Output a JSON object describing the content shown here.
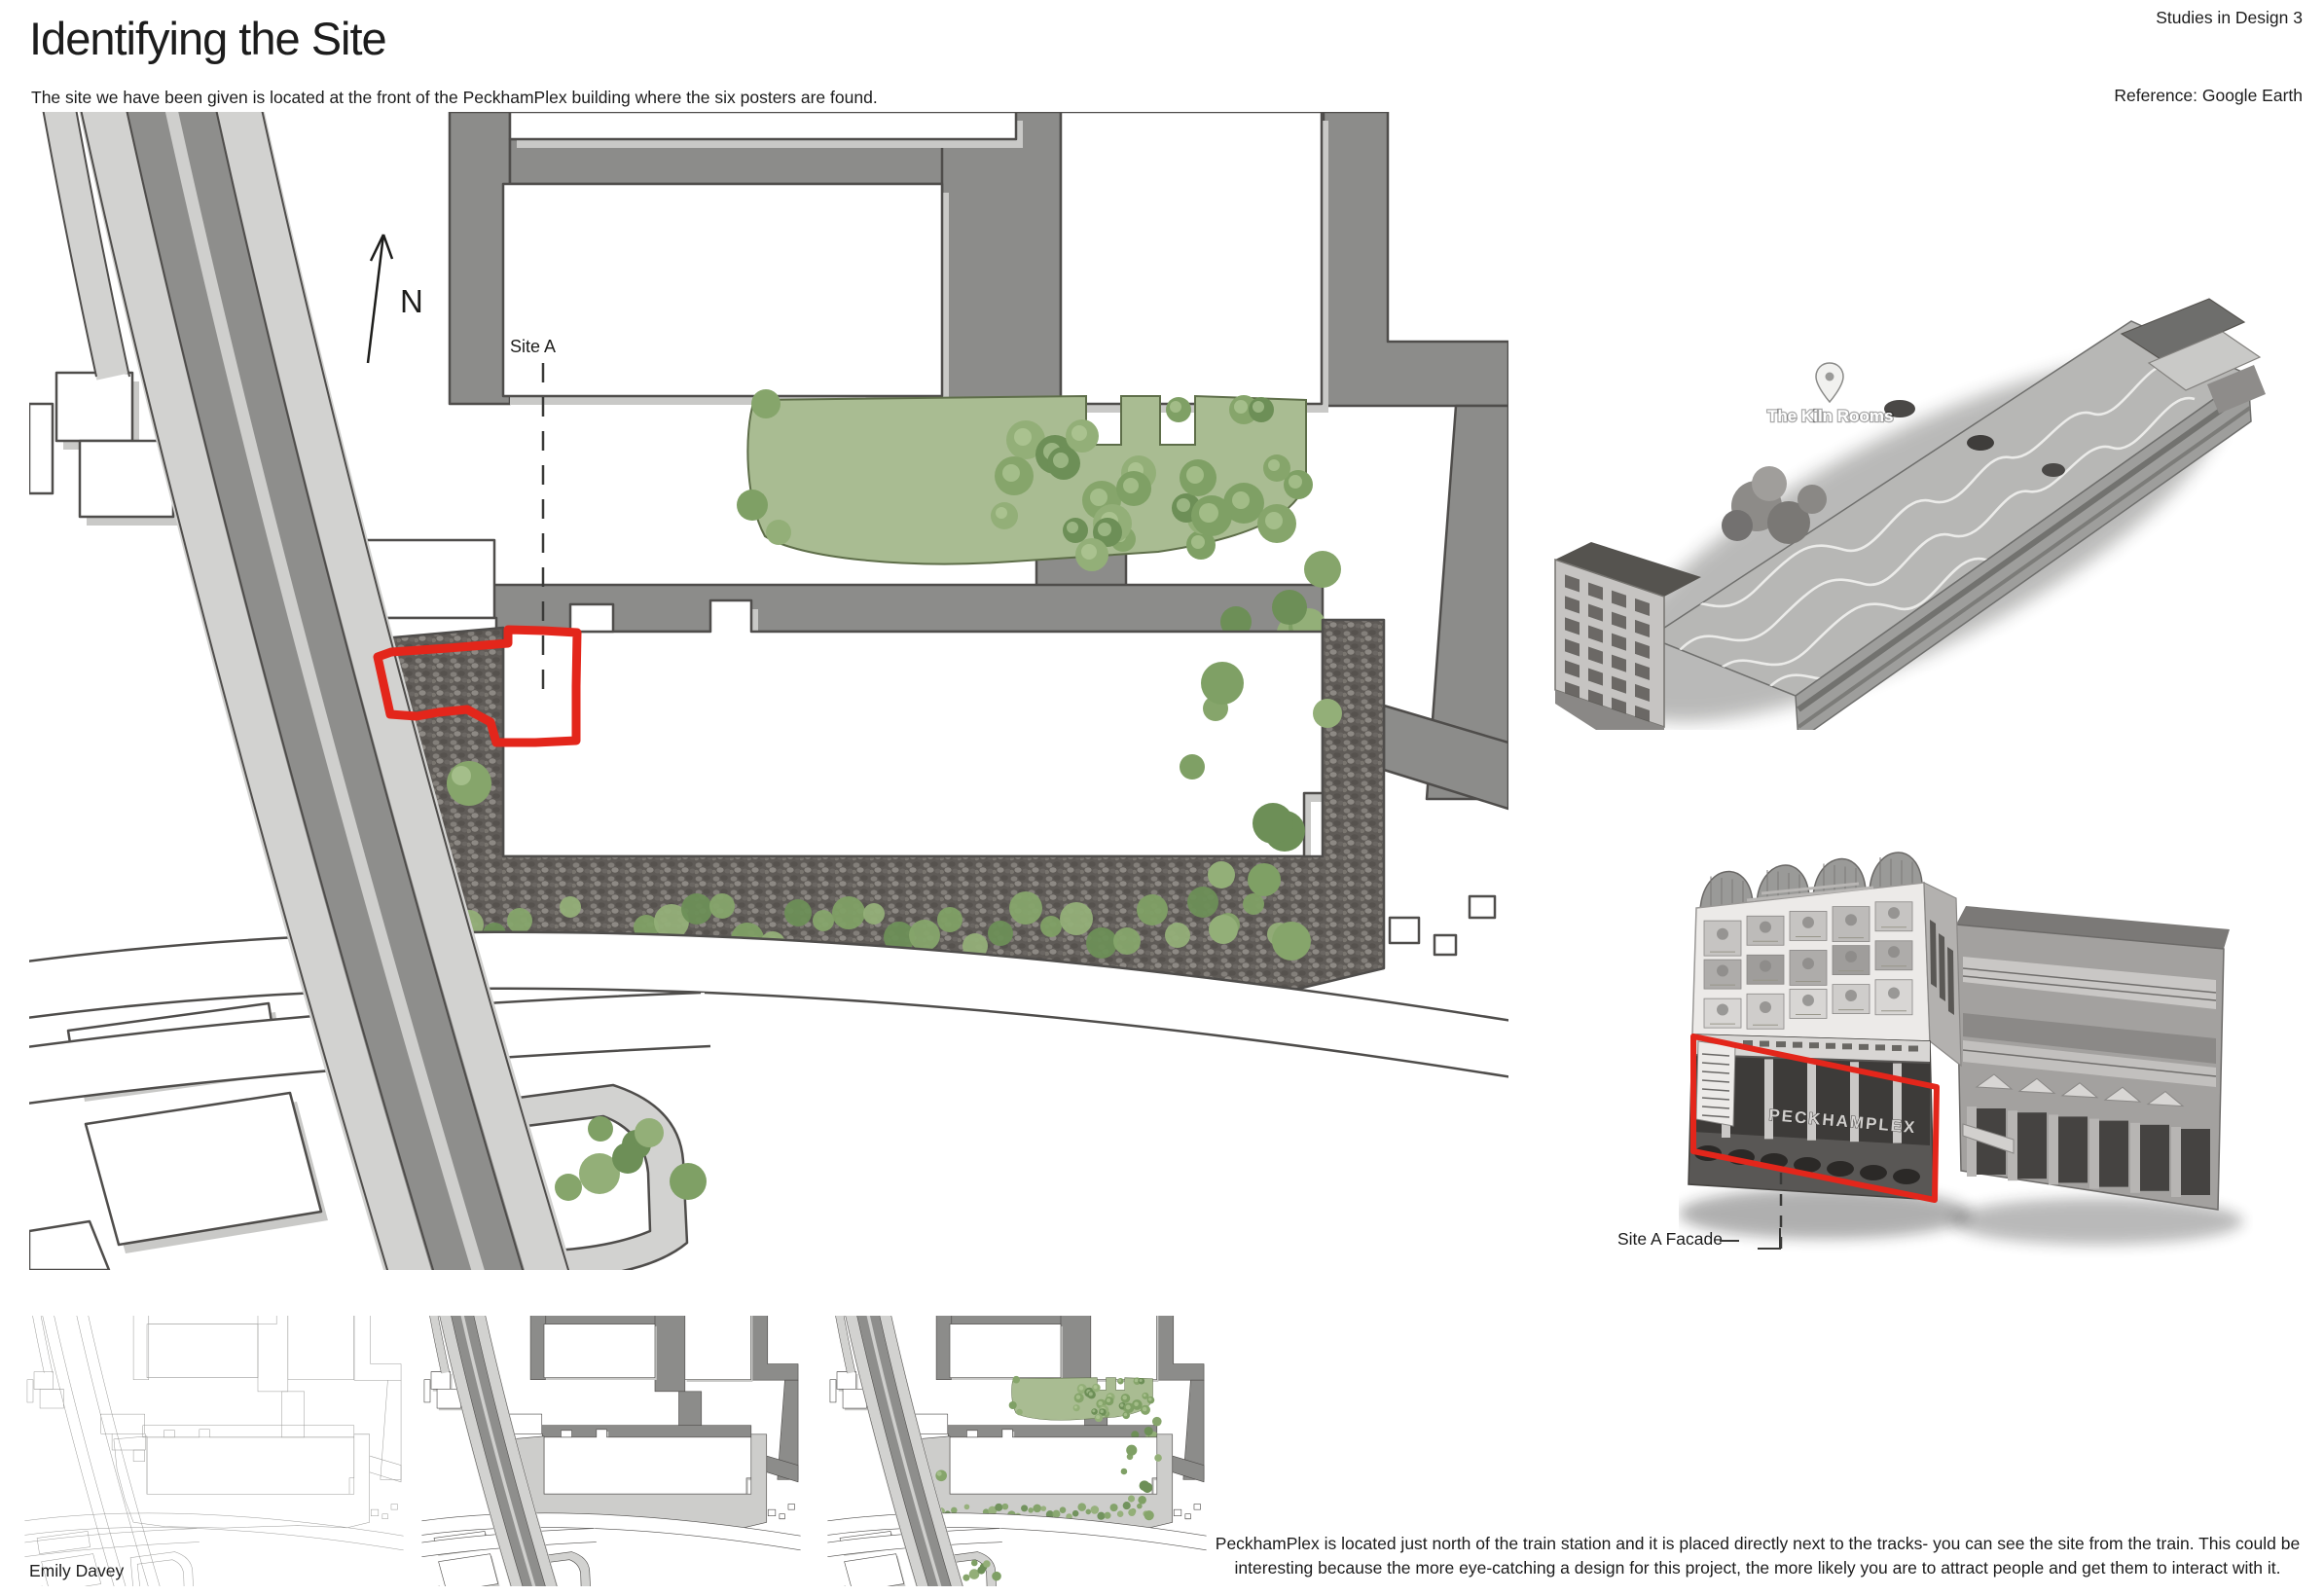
{
  "header": {
    "title": "Identifying the Site",
    "subtitle": "The site we have been given is located at the front of the PeckhamPlex building where the six posters are found.",
    "course_label": "Studies in Design 3",
    "reference_label": "Reference: Google Earth"
  },
  "site_plan": {
    "north_label": "N",
    "site_label": "Site A"
  },
  "aerial_image": {
    "pin_label": "The Kiln Rooms"
  },
  "facade_image": {
    "label": "Site A Facade",
    "signage": "PECKHAMPLEX"
  },
  "footer": {
    "author": "Emily Davey",
    "caption": "PeckhamPlex is located just north of the train station and it is placed directly next to the tracks- you can see the site from the train. This could be interesting because the more eye-catching a design for this project, the more likely you are to attract people and get them to interact with it."
  },
  "colors": {
    "site_outline_red": "#e3261b",
    "lawn_green": "#a9bc92",
    "tree_green": "#87a56b",
    "road_gray": "#8c8c8a",
    "sidewalk_gray": "#d2d2d0",
    "cobble_gray": "#5f5b57"
  }
}
